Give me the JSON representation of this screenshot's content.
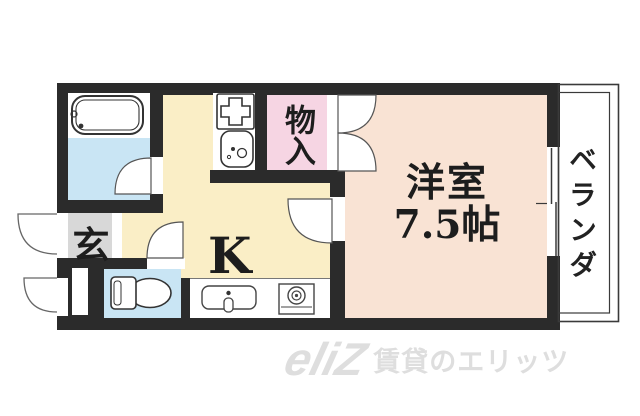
{
  "labels": {
    "closet": "物入",
    "room_name": "洋室",
    "room_size": "7.5帖",
    "kitchen": "K",
    "entrance": "玄",
    "balcony": "ベランダ"
  },
  "watermark": {
    "logo": "eliZ",
    "text": "賃貸のエリッツ"
  },
  "colors": {
    "wall": "#2b2b2b",
    "room-peach": "#f9e3d4",
    "kitchen-cream": "#faeec6",
    "closet-pink": "#f6d5e3",
    "water-blue": "#c9e5f4",
    "entrance-gray": "#d8d8d8",
    "line": "#3a3a3a",
    "watermark-gray": "#dedede",
    "text": "#1d1d1d"
  }
}
